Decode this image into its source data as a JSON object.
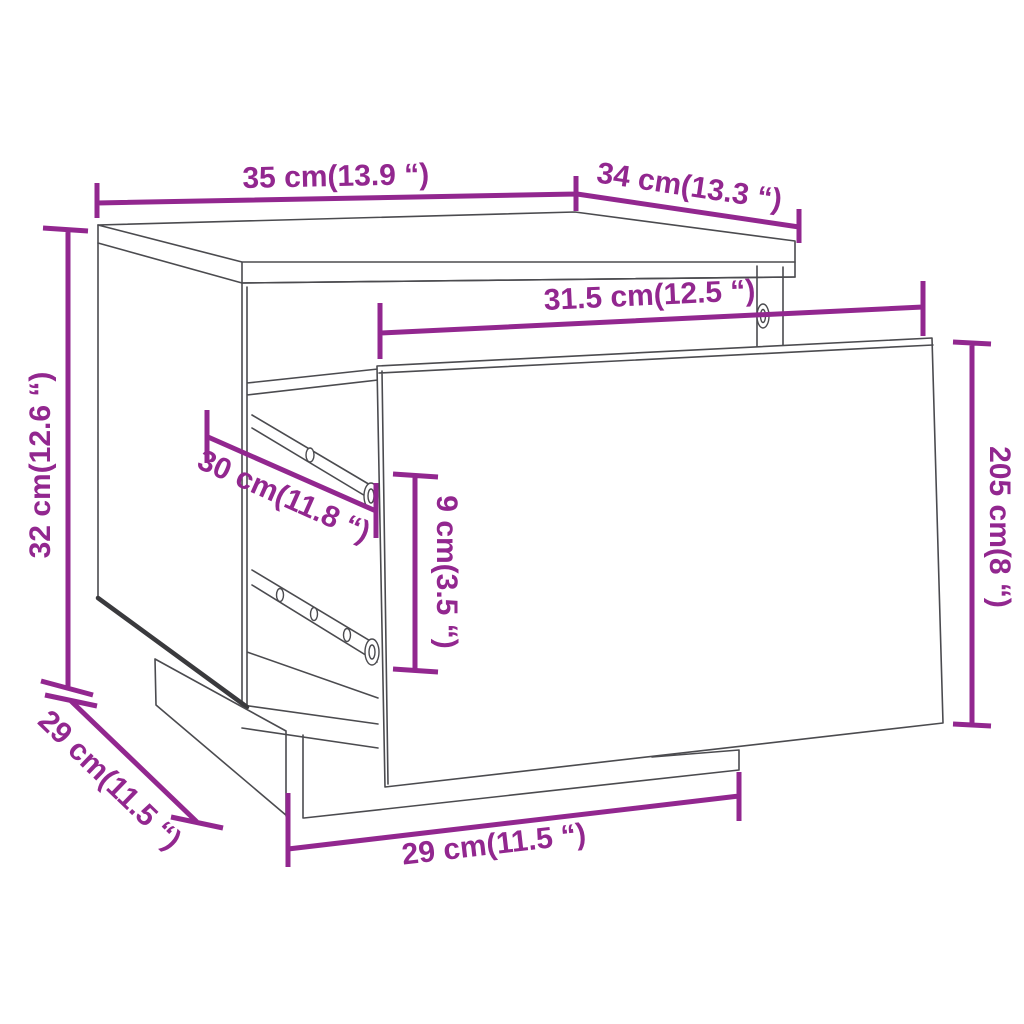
{
  "page": {
    "description": "Technical dimension diagram of a bedside cabinet (nightstand) with its drawer pulled out",
    "background": "#ffffff"
  },
  "colors": {
    "dimension_accent": "#92278F",
    "outline": "#4b4b4f"
  },
  "dimensions": {
    "top_width": "35 cm(13.9 “)",
    "top_depth": "34 cm(13.3 “)",
    "drawer_front_width": "31.5 cm(12.5 “)",
    "overall_height": "32 cm(12.6 “)",
    "drawer_depth": "30 cm(11.8 “)",
    "drawer_inner_height": "9 cm(3.5 “)",
    "drawer_front_height": "205 cm(8 “)",
    "base_width": "29 cm(11.5 “)",
    "base_depth": "29 cm(11.5 “)"
  }
}
